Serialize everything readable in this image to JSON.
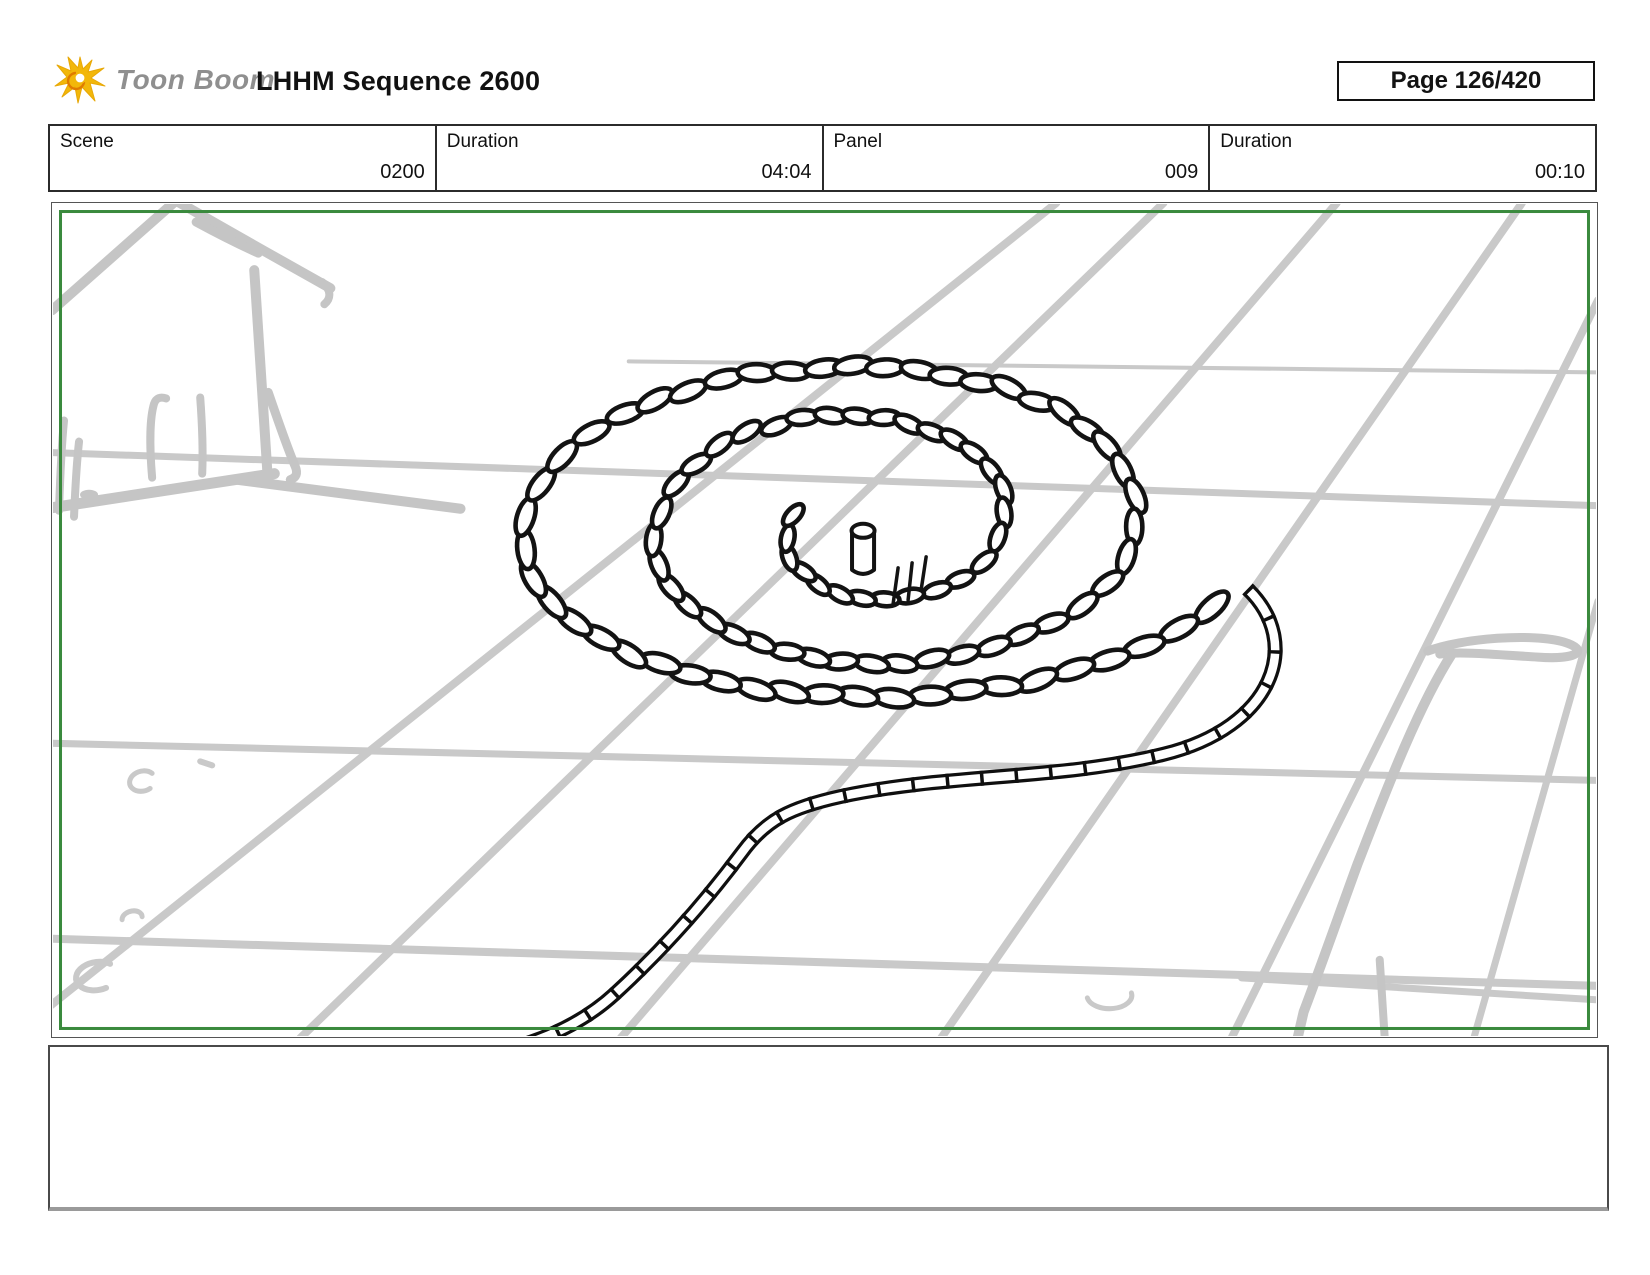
{
  "header": {
    "brand": "Toon Boom",
    "title": "LHHM Sequence 2600",
    "page_label": "Page 126/420"
  },
  "meta_row": {
    "cells": [
      {
        "label": "Scene",
        "value": "0200"
      },
      {
        "label": "Duration",
        "value": "04:04"
      },
      {
        "label": "Panel",
        "value": "009"
      },
      {
        "label": "Duration",
        "value": "00:10"
      }
    ]
  },
  "drawing": {
    "icon": "storyboard-sketch-rope-spiral",
    "colors": {
      "panel_frame_green": "#3a8a3d",
      "sketch_gray": "#c9c9c9",
      "sketch_gray2": "#c5c5c5",
      "ink_black": "#131313",
      "logo_yellow": "#f2b70a",
      "brand_text_gray": "#8f8f8f"
    }
  },
  "notes": {
    "text": ""
  }
}
